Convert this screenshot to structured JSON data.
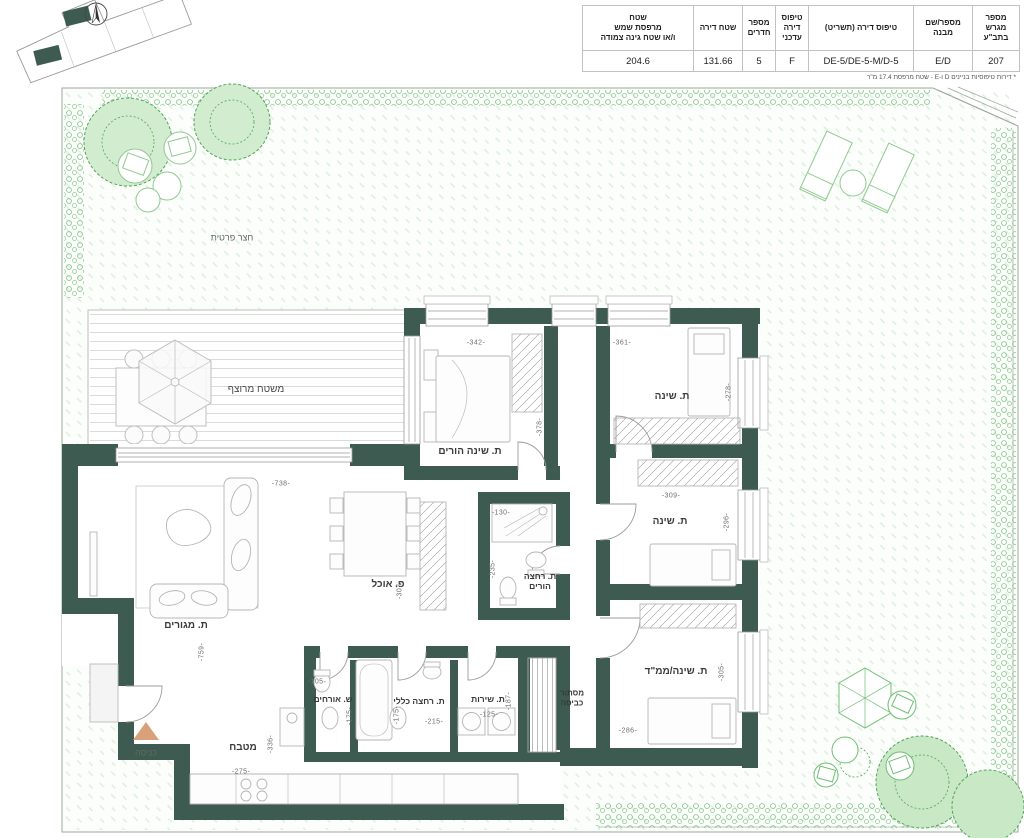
{
  "table": {
    "columns": [
      {
        "header": "מספר\nמגרש\nבתב\"ע",
        "value": "207"
      },
      {
        "header": "מספר/שם מבנה",
        "value": "E/D"
      },
      {
        "header": "טיפוס דירה (תשריט)",
        "value": "DE-5/DE-5-M/D-5"
      },
      {
        "header": "טיפוס\nדירה\nעדכני",
        "value": "F"
      },
      {
        "header": "מספר\nחדרים",
        "value": "5"
      },
      {
        "header": "שטח דירה",
        "value": "131.66"
      },
      {
        "header": "שטח\nמרפסת שמש\nו/או שטח גינה צמודה",
        "value": "204.6"
      }
    ],
    "footnote": "* דירות טיפוסיות בניינים D ו-E - שטח מרפסת 17.4 מ\"ר"
  },
  "plan": {
    "yard_label": "חצר פרטית",
    "deck_label": "משטח מרוצף",
    "entrance_label": "כניסה",
    "rooms": {
      "parents_bedroom": "ת. שינה הורים",
      "bedroom_top": "ת. שינה",
      "bedroom_mid": "ת. שינה",
      "safe_room": "ת. שינה/ממ\"ד",
      "living": "ת. מגורים",
      "dining": "פ. אוכל",
      "parents_bath": "ת. רחצה\nהורים",
      "guest_wc": "ש. אורחים",
      "bath": "ת. רחצה כללי",
      "service": "ת. שירות",
      "laundry": "מסתור כביסה",
      "kitchen": "מטבח"
    },
    "dims": {
      "parents_w": "-342-",
      "bed_top_w": "-361-",
      "hall_h": "-378-",
      "bed_top_h": "-278-",
      "living_w": "-738-",
      "bed_mid_w": "-309-",
      "bed_mid_h": "-296-",
      "pbath_w": "-130-",
      "pbath_h": "-235-",
      "dining_h": "-307-",
      "living_h": "-759-",
      "wc_w": "-105-",
      "wc_h": "-175-",
      "bath_h": "-175-",
      "bath_w": "-215-",
      "service_w": "-125-",
      "service_h": "-187-",
      "safe_h": "-305-",
      "safe_w": "-286-",
      "kitchen_h": "-336-",
      "kitchen_w": "-275-"
    },
    "colors": {
      "wall": "#3d5b51",
      "garden_green": "#6fbf73",
      "entrance_accent": "#d9a179"
    }
  }
}
